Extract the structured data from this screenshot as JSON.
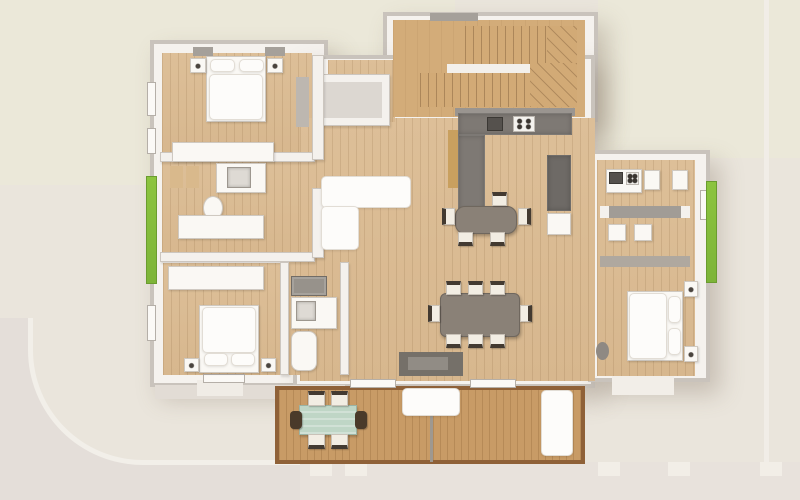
{
  "meta": {
    "title": "3D rendered top-down floor plan of an apartment with terrace",
    "view": "top-down architectural 3D render",
    "rooms": [
      "bedroom-top-left",
      "bathroom-left",
      "corridor-left",
      "bedroom-bottom-left",
      "bathroom-bottom-left",
      "living-room",
      "kitchen",
      "dining-area",
      "staircase",
      "storage-room",
      "studio-kitchenette",
      "studio-bedroom",
      "terrace-deck"
    ]
  },
  "palette": {
    "site_base": "#EAE5DC",
    "lawn_patch": "#EBE8D9",
    "path_gray": "#E4DED9",
    "curb_white": "#F2EFE9",
    "wall_white": "#F5F2EE",
    "wall_edge": "#C9C3BC",
    "wood_floor": "#DCBE97",
    "stair_wood": "#D3AC79",
    "deck_wood": "#C89B66",
    "deck_border": "#8F6138",
    "kitchen_tile": "#7E7974",
    "furniture_white": "#FAF8F4",
    "table_gray": "#8A8177",
    "chair_cream": "#F2EDE3",
    "chair_back": "#433A31",
    "planter_green": "#85BE3F",
    "outdoor_table_teal": "#BFD6C6",
    "sideboard_wood": "#C9A05F"
  },
  "canvas": {
    "w": 800,
    "h": 500
  },
  "elements": [
    {
      "name": "site-ground",
      "cls": "",
      "x": 0,
      "y": 0,
      "w": 800,
      "h": 500,
      "color": "#EAE5DC"
    },
    {
      "name": "lawn-patch-top-left",
      "cls": "",
      "x": 0,
      "y": 0,
      "w": 455,
      "h": 185,
      "color": "#EBE8D9"
    },
    {
      "name": "lawn-patch-top-right",
      "cls": "",
      "x": 598,
      "y": 0,
      "w": 202,
      "h": 158,
      "color": "#EBE8D9"
    },
    {
      "name": "path-right-band",
      "cls": "",
      "x": 764,
      "y": 0,
      "w": 5,
      "h": 500,
      "color": "#F1EDE7"
    },
    {
      "name": "path-corner-gray",
      "cls": "",
      "x": 0,
      "y": 318,
      "w": 305,
      "h": 182,
      "color": "#E4DED9"
    },
    {
      "name": "path-corner-curb",
      "cls": "curb",
      "x": 28,
      "y": 318,
      "w": 277,
      "h": 147,
      "color": "#EAE5DC"
    },
    {
      "name": "path-bottom-band",
      "cls": "",
      "x": 300,
      "y": 462,
      "w": 500,
      "h": 38,
      "color": "#E8E2DC"
    },
    {
      "name": "fence-post-1",
      "cls": "",
      "x": 310,
      "y": 462,
      "w": 22,
      "h": 14,
      "color": "#F2EEE7"
    },
    {
      "name": "fence-post-2",
      "cls": "",
      "x": 345,
      "y": 462,
      "w": 22,
      "h": 14,
      "color": "#F2EEE7"
    },
    {
      "name": "fence-post-3",
      "cls": "",
      "x": 598,
      "y": 462,
      "w": 22,
      "h": 14,
      "color": "#F2EEE7"
    },
    {
      "name": "fence-post-4",
      "cls": "",
      "x": 668,
      "y": 462,
      "w": 22,
      "h": 14,
      "color": "#F2EEE7"
    },
    {
      "name": "fence-post-5",
      "cls": "",
      "x": 760,
      "y": 462,
      "w": 22,
      "h": 14,
      "color": "#F2EEE7"
    },
    {
      "name": "building-wing-left",
      "cls": "wall",
      "x": 150,
      "y": 40,
      "w": 178,
      "h": 347
    },
    {
      "name": "building-stair-block",
      "cls": "wall",
      "x": 383,
      "y": 12,
      "w": 215,
      "h": 110
    },
    {
      "name": "building-center-block",
      "cls": "wall",
      "x": 293,
      "y": 55,
      "w": 302,
      "h": 333
    },
    {
      "name": "building-wing-right",
      "cls": "wall",
      "x": 588,
      "y": 150,
      "w": 122,
      "h": 232
    },
    {
      "name": "apron-bottom-left",
      "cls": "",
      "x": 155,
      "y": 385,
      "w": 190,
      "h": 14,
      "color": "#E2DCD5"
    },
    {
      "name": "porch-step-bl",
      "cls": "",
      "x": 197,
      "y": 380,
      "w": 46,
      "h": 16,
      "color": "#F0ECE6"
    },
    {
      "name": "porch-entry-right",
      "cls": "",
      "x": 612,
      "y": 375,
      "w": 62,
      "h": 20,
      "color": "#F2EEE8"
    },
    {
      "name": "floor-bedroom-tl",
      "cls": "wood",
      "x": 162,
      "y": 53,
      "w": 150,
      "h": 104
    },
    {
      "name": "floor-hall-bath-left",
      "cls": "wood",
      "x": 162,
      "y": 160,
      "w": 153,
      "h": 100
    },
    {
      "name": "floor-bedroom-bl",
      "cls": "wood",
      "x": 163,
      "y": 263,
      "w": 126,
      "h": 112
    },
    {
      "name": "floor-bath-bl",
      "cls": "wood",
      "x": 287,
      "y": 260,
      "w": 54,
      "h": 115
    },
    {
      "name": "floor-living-center",
      "cls": "wood",
      "x": 300,
      "y": 118,
      "w": 295,
      "h": 263
    },
    {
      "name": "floor-hall-top",
      "cls": "wood",
      "x": 328,
      "y": 60,
      "w": 67,
      "h": 62
    },
    {
      "name": "floor-stairwell",
      "cls": "wood-stair",
      "x": 393,
      "y": 20,
      "w": 192,
      "h": 97
    },
    {
      "name": "floor-studio-right",
      "cls": "wood",
      "x": 597,
      "y": 160,
      "w": 98,
      "h": 216
    },
    {
      "name": "terrace-deck",
      "cls": "deck",
      "x": 275,
      "y": 386,
      "w": 310,
      "h": 78
    },
    {
      "name": "storage-room-walls",
      "cls": "wall-in",
      "x": 316,
      "y": 74,
      "w": 74,
      "h": 52
    },
    {
      "name": "storage-room-floor",
      "cls": "",
      "x": 324,
      "y": 82,
      "w": 58,
      "h": 36,
      "color": "#DCD7D1"
    },
    {
      "name": "stair-flight-upper",
      "cls": "treads",
      "x": 465,
      "y": 26,
      "w": 82,
      "h": 38
    },
    {
      "name": "stair-winder-upper",
      "cls": "winder",
      "x": 547,
      "y": 26,
      "w": 30,
      "h": 38
    },
    {
      "name": "stair-stringer",
      "cls": "",
      "x": 447,
      "y": 64,
      "w": 100,
      "h": 9,
      "color": "#F3F0EB"
    },
    {
      "name": "stair-flight-lower",
      "cls": "treads",
      "x": 420,
      "y": 73,
      "w": 110,
      "h": 34
    },
    {
      "name": "stair-winder-lower",
      "cls": "winder",
      "x": 530,
      "y": 63,
      "w": 47,
      "h": 44
    },
    {
      "name": "stair-window-lintel",
      "cls": "sill",
      "x": 430,
      "y": 13,
      "w": 48,
      "h": 8
    },
    {
      "name": "wall-bedroom-tl-south",
      "cls": "wall-in",
      "x": 160,
      "y": 152,
      "w": 155,
      "h": 10
    },
    {
      "name": "wall-corridor-south",
      "cls": "wall-in",
      "x": 160,
      "y": 252,
      "w": 155,
      "h": 10
    },
    {
      "name": "wall-leftwing-east-upper",
      "cls": "wall-in",
      "x": 312,
      "y": 55,
      "w": 12,
      "h": 105
    },
    {
      "name": "wall-leftwing-east-lower",
      "cls": "wall-in",
      "x": 312,
      "y": 188,
      "w": 12,
      "h": 70
    },
    {
      "name": "wall-bathbl-west",
      "cls": "wall-in",
      "x": 280,
      "y": 262,
      "w": 9,
      "h": 113
    },
    {
      "name": "wall-bathbl-east",
      "cls": "wall-in",
      "x": 340,
      "y": 262,
      "w": 9,
      "h": 113
    },
    {
      "name": "wall-kitchen-backsplash",
      "cls": "",
      "x": 455,
      "y": 108,
      "w": 120,
      "h": 8,
      "color": "#9A9590"
    },
    {
      "name": "wall-studio-divider",
      "cls": "",
      "x": 600,
      "y": 256,
      "w": 90,
      "h": 11,
      "color": "#AFA89F"
    },
    {
      "name": "window-left-1",
      "cls": "window",
      "x": 147,
      "y": 82,
      "w": 9,
      "h": 34
    },
    {
      "name": "window-left-2",
      "cls": "window",
      "x": 147,
      "y": 128,
      "w": 9,
      "h": 26
    },
    {
      "name": "window-left-3",
      "cls": "window",
      "x": 147,
      "y": 305,
      "w": 9,
      "h": 36
    },
    {
      "name": "window-sill-tl-1",
      "cls": "sill",
      "x": 193,
      "y": 47,
      "w": 20,
      "h": 9
    },
    {
      "name": "window-sill-tl-2",
      "cls": "sill",
      "x": 265,
      "y": 47,
      "w": 20,
      "h": 9
    },
    {
      "name": "window-bottom-bl",
      "cls": "window",
      "x": 203,
      "y": 374,
      "w": 42,
      "h": 9
    },
    {
      "name": "window-bottom-living-1",
      "cls": "window",
      "x": 350,
      "y": 379,
      "w": 46,
      "h": 9
    },
    {
      "name": "window-bottom-living-2",
      "cls": "window",
      "x": 470,
      "y": 379,
      "w": 46,
      "h": 9
    },
    {
      "name": "window-right-1",
      "cls": "window",
      "x": 700,
      "y": 190,
      "w": 9,
      "h": 30
    },
    {
      "name": "planter-left",
      "cls": "green",
      "x": 146,
      "y": 176,
      "w": 11,
      "h": 108
    },
    {
      "name": "planter-right",
      "cls": "green",
      "x": 706,
      "y": 181,
      "w": 11,
      "h": 102
    },
    {
      "name": "bed-tl-base",
      "cls": "furn",
      "x": 206,
      "y": 56,
      "w": 60,
      "h": 66
    },
    {
      "name": "bed-tl-pillow-left",
      "cls": "bright",
      "x": 210,
      "y": 59,
      "w": 25,
      "h": 13
    },
    {
      "name": "bed-tl-pillow-right",
      "cls": "bright",
      "x": 239,
      "y": 59,
      "w": 25,
      "h": 13
    },
    {
      "name": "bed-tl-duvet",
      "cls": "bright",
      "x": 209,
      "y": 74,
      "w": 54,
      "h": 46
    },
    {
      "name": "nightstand-tl-left",
      "cls": "furn-dot",
      "x": 190,
      "y": 58,
      "w": 16,
      "h": 15
    },
    {
      "name": "nightstand-tl-right",
      "cls": "furn-dot",
      "x": 267,
      "y": 58,
      "w": 16,
      "h": 15
    },
    {
      "name": "wardrobe-tl",
      "cls": "furn",
      "x": 172,
      "y": 142,
      "w": 102,
      "h": 20
    },
    {
      "name": "dresser-tl-east",
      "cls": "",
      "x": 296,
      "y": 77,
      "w": 13,
      "h": 50,
      "color": "#BDB7B0"
    },
    {
      "name": "bath1-cabinet-1",
      "cls": "",
      "x": 170,
      "y": 166,
      "w": 13,
      "h": 22,
      "color": "#D9B98C"
    },
    {
      "name": "bath1-cabinet-2",
      "cls": "",
      "x": 186,
      "y": 166,
      "w": 13,
      "h": 22,
      "color": "#D9B98C"
    },
    {
      "name": "bath1-vanity",
      "cls": "furn",
      "x": 216,
      "y": 163,
      "w": 50,
      "h": 30
    },
    {
      "name": "bath1-sink",
      "cls": "sink",
      "x": 227,
      "y": 167,
      "w": 24,
      "h": 21
    },
    {
      "name": "bath1-toilet",
      "cls": "furn oval",
      "x": 203,
      "y": 196,
      "w": 20,
      "h": 24
    },
    {
      "name": "corridor-closet",
      "cls": "furn",
      "x": 178,
      "y": 215,
      "w": 86,
      "h": 24
    },
    {
      "name": "wardrobe-bl",
      "cls": "furn",
      "x": 168,
      "y": 266,
      "w": 96,
      "h": 24
    },
    {
      "name": "bed-bl-base",
      "cls": "furn",
      "x": 199,
      "y": 305,
      "w": 60,
      "h": 68
    },
    {
      "name": "bed-bl-duvet",
      "cls": "bright",
      "x": 202,
      "y": 307,
      "w": 54,
      "h": 46
    },
    {
      "name": "bed-bl-pillow-left",
      "cls": "bright",
      "x": 204,
      "y": 353,
      "w": 24,
      "h": 13
    },
    {
      "name": "bed-bl-pillow-right",
      "cls": "bright",
      "x": 231,
      "y": 353,
      "w": 24,
      "h": 13
    },
    {
      "name": "nightstand-bl-left",
      "cls": "furn-dot",
      "x": 184,
      "y": 358,
      "w": 15,
      "h": 14
    },
    {
      "name": "nightstand-bl-right",
      "cls": "furn-dot",
      "x": 261,
      "y": 358,
      "w": 15,
      "h": 14
    },
    {
      "name": "bath2-washer",
      "cls": "appl",
      "x": 291,
      "y": 276,
      "w": 36,
      "h": 20
    },
    {
      "name": "bath2-vanity",
      "cls": "furn",
      "x": 291,
      "y": 297,
      "w": 46,
      "h": 32
    },
    {
      "name": "bath2-sink",
      "cls": "sink",
      "x": 296,
      "y": 301,
      "w": 20,
      "h": 20
    },
    {
      "name": "bath2-tub",
      "cls": "furn",
      "x": 291,
      "y": 331,
      "w": 26,
      "h": 40,
      "r": 8
    },
    {
      "name": "sofa-l-horizontal",
      "cls": "bright",
      "x": 321,
      "y": 176,
      "w": 90,
      "h": 32
    },
    {
      "name": "sofa-l-vertical",
      "cls": "bright",
      "x": 321,
      "y": 206,
      "w": 38,
      "h": 44
    },
    {
      "name": "sideboard-kitchen-wood",
      "cls": "",
      "x": 448,
      "y": 130,
      "w": 11,
      "h": 58,
      "color": "#C9A05F"
    },
    {
      "name": "tv-sideboard-outer",
      "cls": "",
      "x": 399,
      "y": 352,
      "w": 64,
      "h": 24,
      "color": "#757069"
    },
    {
      "name": "tv-sideboard-inner",
      "cls": "",
      "x": 408,
      "y": 357,
      "w": 40,
      "h": 13,
      "color": "#918C85"
    },
    {
      "name": "kitchen-counter-top",
      "cls": "tile",
      "x": 458,
      "y": 113,
      "w": 114,
      "h": 22
    },
    {
      "name": "kitchen-counter-left",
      "cls": "tile",
      "x": 458,
      "y": 135,
      "w": 27,
      "h": 76
    },
    {
      "name": "kitchen-sink",
      "cls": "dark",
      "x": 487,
      "y": 117,
      "w": 16,
      "h": 14
    },
    {
      "name": "kitchen-cooktop",
      "cls": "burners",
      "x": 513,
      "y": 116,
      "w": 22,
      "h": 16
    },
    {
      "name": "kitchen-tall-unit",
      "cls": "tile",
      "x": 547,
      "y": 155,
      "w": 24,
      "h": 56,
      "color": "#6E6A66"
    },
    {
      "name": "kitchen-white-unit",
      "cls": "furn",
      "x": 547,
      "y": 213,
      "w": 24,
      "h": 22
    },
    {
      "name": "kitchen-table",
      "cls": "table",
      "x": 455,
      "y": 206,
      "w": 62,
      "h": 28,
      "r": 10
    },
    {
      "name": "kitchen-chair-top",
      "cls": "chair back-n",
      "x": 492,
      "y": 192,
      "w": 15,
      "h": 14
    },
    {
      "name": "kitchen-chair-left",
      "cls": "chair back-w",
      "x": 442,
      "y": 208,
      "w": 13,
      "h": 17
    },
    {
      "name": "kitchen-chair-right",
      "cls": "chair back-e",
      "x": 518,
      "y": 208,
      "w": 13,
      "h": 17
    },
    {
      "name": "kitchen-chair-bottom-1",
      "cls": "chair back-s",
      "x": 458,
      "y": 232,
      "w": 15,
      "h": 14
    },
    {
      "name": "kitchen-chair-bottom-2",
      "cls": "chair back-s",
      "x": 490,
      "y": 232,
      "w": 15,
      "h": 14
    },
    {
      "name": "dining-table",
      "cls": "table",
      "x": 440,
      "y": 293,
      "w": 80,
      "h": 44,
      "r": 6
    },
    {
      "name": "dining-chair-top-1",
      "cls": "chair back-n",
      "x": 446,
      "y": 281,
      "w": 15,
      "h": 14
    },
    {
      "name": "dining-chair-top-2",
      "cls": "chair back-n",
      "x": 468,
      "y": 281,
      "w": 15,
      "h": 14
    },
    {
      "name": "dining-chair-top-3",
      "cls": "chair back-n",
      "x": 490,
      "y": 281,
      "w": 15,
      "h": 14
    },
    {
      "name": "dining-chair-bottom-1",
      "cls": "chair back-s",
      "x": 446,
      "y": 334,
      "w": 15,
      "h": 14
    },
    {
      "name": "dining-chair-bottom-2",
      "cls": "chair back-s",
      "x": 468,
      "y": 334,
      "w": 15,
      "h": 14
    },
    {
      "name": "dining-chair-bottom-3",
      "cls": "chair back-s",
      "x": 490,
      "y": 334,
      "w": 15,
      "h": 14
    },
    {
      "name": "dining-chair-left",
      "cls": "chair back-w",
      "x": 428,
      "y": 305,
      "w": 12,
      "h": 17
    },
    {
      "name": "dining-chair-right",
      "cls": "chair back-e",
      "x": 520,
      "y": 305,
      "w": 12,
      "h": 17
    },
    {
      "name": "studio-kitchenette",
      "cls": "furn",
      "x": 606,
      "y": 169,
      "w": 36,
      "h": 24
    },
    {
      "name": "studio-kitchenette-sink",
      "cls": "dark",
      "x": 609,
      "y": 172,
      "w": 14,
      "h": 12
    },
    {
      "name": "studio-kitchenette-burners",
      "cls": "burners",
      "x": 626,
      "y": 172,
      "w": 13,
      "h": 13
    },
    {
      "name": "studio-unit-1",
      "cls": "furn",
      "x": 644,
      "y": 170,
      "w": 16,
      "h": 20
    },
    {
      "name": "studio-unit-2",
      "cls": "furn",
      "x": 672,
      "y": 170,
      "w": 16,
      "h": 20
    },
    {
      "name": "studio-counter",
      "cls": "",
      "x": 600,
      "y": 206,
      "w": 90,
      "h": 12,
      "color": "#A19C96"
    },
    {
      "name": "studio-counter-cap-left",
      "cls": "",
      "x": 600,
      "y": 206,
      "w": 9,
      "h": 12,
      "color": "#F4F1ED"
    },
    {
      "name": "studio-counter-cap-right",
      "cls": "",
      "x": 681,
      "y": 206,
      "w": 9,
      "h": 12,
      "color": "#F4F1ED"
    },
    {
      "name": "studio-stool-1",
      "cls": "furn",
      "x": 608,
      "y": 224,
      "w": 18,
      "h": 17
    },
    {
      "name": "studio-stool-2",
      "cls": "furn",
      "x": 634,
      "y": 224,
      "w": 18,
      "h": 17
    },
    {
      "name": "bed-right-base",
      "cls": "furn",
      "x": 627,
      "y": 291,
      "w": 56,
      "h": 70
    },
    {
      "name": "bed-right-duvet",
      "cls": "bright",
      "x": 629,
      "y": 293,
      "w": 38,
      "h": 66
    },
    {
      "name": "bed-right-pillow-top",
      "cls": "bright",
      "x": 668,
      "y": 296,
      "w": 13,
      "h": 27
    },
    {
      "name": "bed-right-pillow-bottom",
      "cls": "bright",
      "x": 668,
      "y": 328,
      "w": 13,
      "h": 27
    },
    {
      "name": "nightstand-right-top",
      "cls": "furn-dot",
      "x": 684,
      "y": 281,
      "w": 14,
      "h": 16
    },
    {
      "name": "nightstand-right-bottom",
      "cls": "furn-dot",
      "x": 684,
      "y": 346,
      "w": 14,
      "h": 16
    },
    {
      "name": "pouf-studio",
      "cls": "oval",
      "x": 596,
      "y": 342,
      "w": 13,
      "h": 18,
      "color": "#8F8983"
    },
    {
      "name": "terrace-divider",
      "cls": "",
      "x": 430,
      "y": 388,
      "w": 3,
      "h": 74,
      "color": "#9E9890"
    },
    {
      "name": "outdoor-table",
      "cls": "teal",
      "x": 299,
      "y": 405,
      "w": 58,
      "h": 30
    },
    {
      "name": "outdoor-chair-top-1",
      "cls": "chair back-n",
      "x": 308,
      "y": 391,
      "w": 17,
      "h": 15
    },
    {
      "name": "outdoor-chair-top-2",
      "cls": "chair back-n",
      "x": 331,
      "y": 391,
      "w": 17,
      "h": 15
    },
    {
      "name": "outdoor-chair-bottom-1",
      "cls": "chair back-s",
      "x": 308,
      "y": 434,
      "w": 17,
      "h": 15
    },
    {
      "name": "outdoor-chair-bottom-2",
      "cls": "chair back-s",
      "x": 331,
      "y": 434,
      "w": 17,
      "h": 15
    },
    {
      "name": "outdoor-chair-end-left",
      "cls": "chair-dark",
      "x": 290,
      "y": 411,
      "w": 12,
      "h": 18
    },
    {
      "name": "outdoor-chair-end-right",
      "cls": "chair-dark",
      "x": 355,
      "y": 411,
      "w": 12,
      "h": 18
    },
    {
      "name": "terrace-sofa-top",
      "cls": "bright",
      "x": 402,
      "y": 388,
      "w": 58,
      "h": 28
    },
    {
      "name": "terrace-sofa-right",
      "cls": "bright",
      "x": 541,
      "y": 390,
      "w": 32,
      "h": 66
    }
  ]
}
